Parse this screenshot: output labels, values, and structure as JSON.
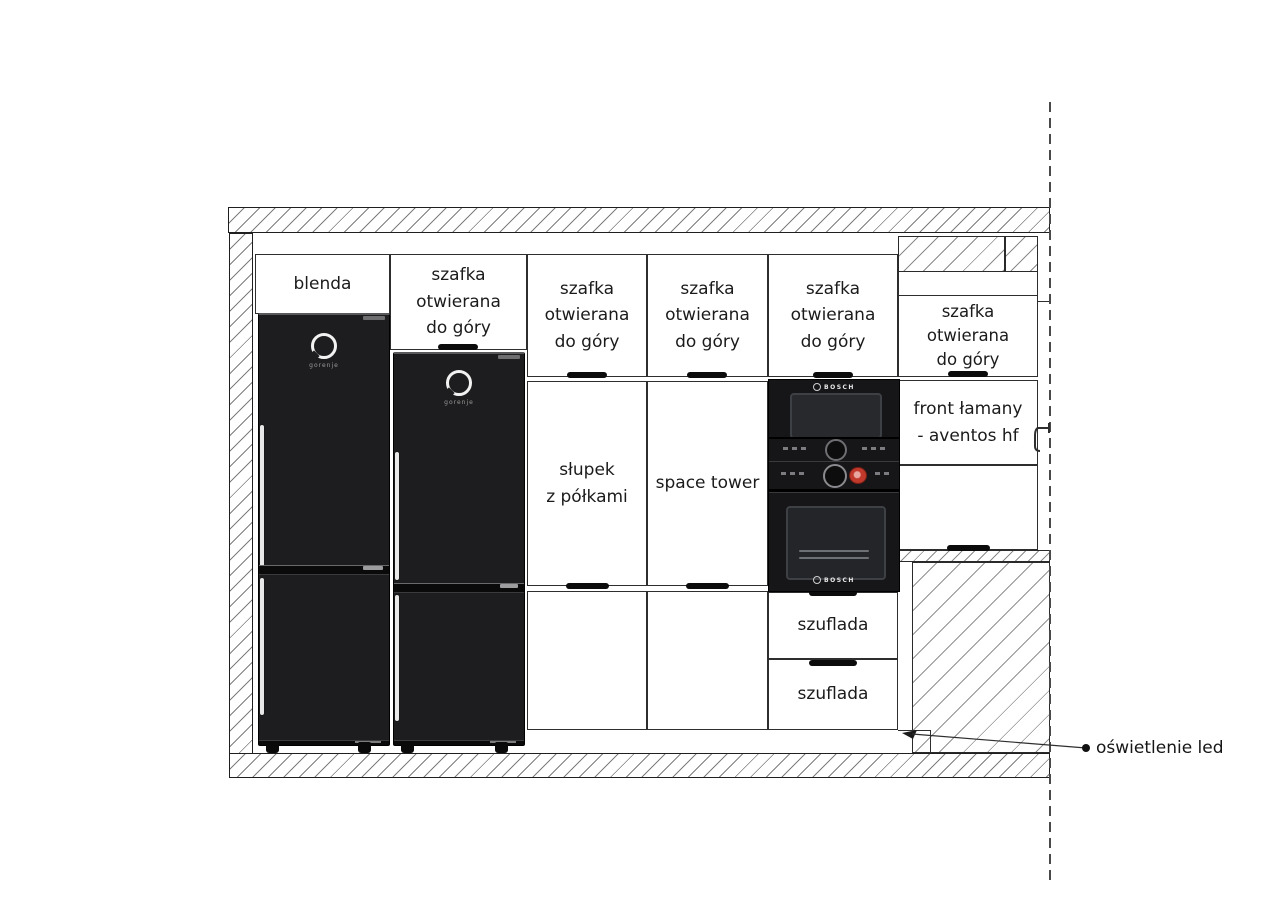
{
  "drawing_title": "kitchen cabinet elevation",
  "columns": [
    {
      "name": "fridge-column-1",
      "top": "blenda",
      "brand": "gorenje"
    },
    {
      "name": "fridge-column-2",
      "top": "szafka\notwierana\ndo góry",
      "brand": "gorenje"
    },
    {
      "name": "slupek-column",
      "top": "szafka\notwierana\ndo góry",
      "middle": "słupek\nz półkami"
    },
    {
      "name": "space-tower-column",
      "top": "szafka\notwierana\ndo góry",
      "middle": "space tower"
    },
    {
      "name": "appliance-column",
      "top": "szafka\notwierana\ndo góry",
      "brand_top": "BOSCH",
      "brand_bottom": "BOSCH",
      "drawers": [
        "szuflada",
        "szuflada"
      ]
    },
    {
      "name": "right-column",
      "top": "szafka\notwierana\ndo góry",
      "middle": "front łamany\n- aventos hf"
    }
  ],
  "annotation": {
    "led": "oświetlenie led"
  },
  "colors": {
    "line": "#2e2e2e",
    "hatch": "#8a8a8a",
    "appliance_black": "#1d1d1f",
    "display_red": "#c0392b"
  }
}
